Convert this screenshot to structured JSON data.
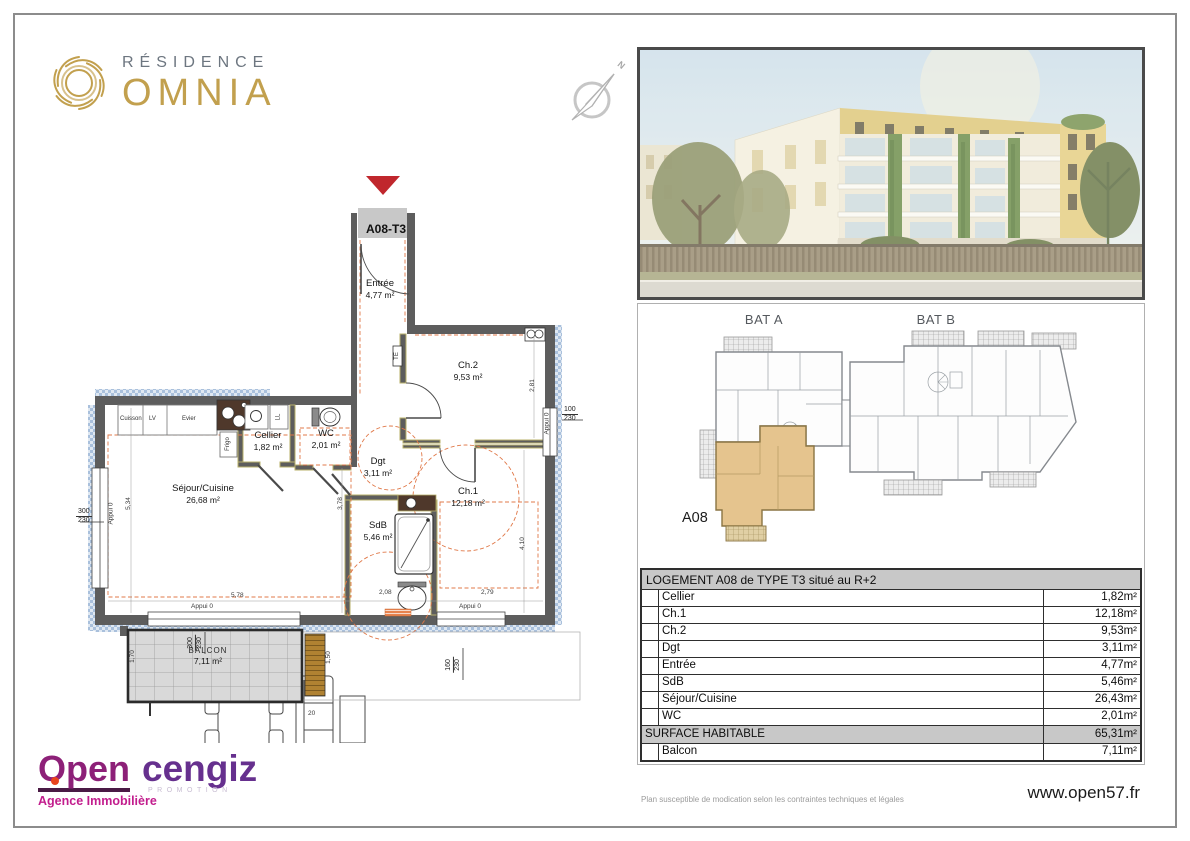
{
  "brand": {
    "line1": "RÉSIDENCE",
    "line2": "OMNIA"
  },
  "compass": {
    "north": "N"
  },
  "plan": {
    "unit": "A08-T3",
    "appui": "Appui 0",
    "rooms": {
      "entree": {
        "name": "Entrée",
        "area": "4,77 m²"
      },
      "ch2": {
        "name": "Ch.2",
        "area": "9,53 m²"
      },
      "cellier": {
        "name": "Cellier",
        "area": "1,82 m²"
      },
      "wc": {
        "name": "WC",
        "area": "2,01 m²"
      },
      "dgt": {
        "name": "Dgt",
        "area": "3,11 m²"
      },
      "ch1": {
        "name": "Ch.1",
        "area": "12,18 m²"
      },
      "sdb": {
        "name": "SdB",
        "area": "5,46 m²"
      },
      "sejour": {
        "name": "Séjour/Cuisine",
        "area": "26,68 m²"
      },
      "balcon": {
        "name": "BALCON",
        "area": "7,11 m²"
      }
    },
    "kitchen": {
      "cuisson": "Cuisson",
      "lv": "LV",
      "evier": "Evier",
      "frigo": "Frigo",
      "ll": "LL",
      "te": "TE"
    },
    "dims": {
      "d534": "5,34",
      "d378": "3,78",
      "d281": "2,81",
      "d410": "4,10",
      "d578": "5,78",
      "d208": "2,08",
      "d279": "2,79",
      "d170": "1,70",
      "d150": "1,50",
      "d20": "20",
      "w300": "300",
      "w230": "230",
      "w100": "100",
      "w160": "160",
      "b300": "300",
      "b230": "230"
    }
  },
  "keyplan": {
    "bat_a": "BAT A",
    "bat_b": "BAT B",
    "unit": "A08"
  },
  "table": {
    "title": "LOGEMENT A08 de TYPE T3 situé au R+2",
    "rows": [
      {
        "label": "Cellier",
        "value": "1,82m²"
      },
      {
        "label": "Ch.1",
        "value": "12,18m²"
      },
      {
        "label": "Ch.2",
        "value": "9,53m²"
      },
      {
        "label": "Dgt",
        "value": "3,11m²"
      },
      {
        "label": "Entrée",
        "value": "4,77m²"
      },
      {
        "label": "SdB",
        "value": "5,46m²"
      },
      {
        "label": "Séjour/Cuisine",
        "value": "26,43m²"
      },
      {
        "label": "WC",
        "value": "2,01m²"
      }
    ],
    "surface": {
      "label": "SURFACE HABITABLE",
      "value": "65,31m²"
    },
    "balcon": {
      "label": "Balcon",
      "value": "7,11m²"
    }
  },
  "footer": {
    "disclaimer": "Plan susceptible de modication selon les contraintes techniques et légales",
    "website": "www.open57.fr"
  },
  "agency": {
    "name": "Open",
    "tagline": "Agence Immobilière"
  },
  "promoter": {
    "name": "cengiz",
    "tagline": "PROMOTION"
  },
  "colors": {
    "gold": "#c2a04e",
    "residence_gray": "#6d7680",
    "entry_marker_red": "#c0272d",
    "wall_gray": "#5d5d5d",
    "hatch_blue": "#b7cbe4",
    "partition_lining": "#b8b06a",
    "dashed_orange": "#e07848",
    "unit_highlight": "#e5c48e",
    "table_header_bg": "#c8c8c8",
    "open_purple": "#8d2078",
    "open_magenta": "#c21d8d",
    "cengiz_purple": "#66308e"
  }
}
